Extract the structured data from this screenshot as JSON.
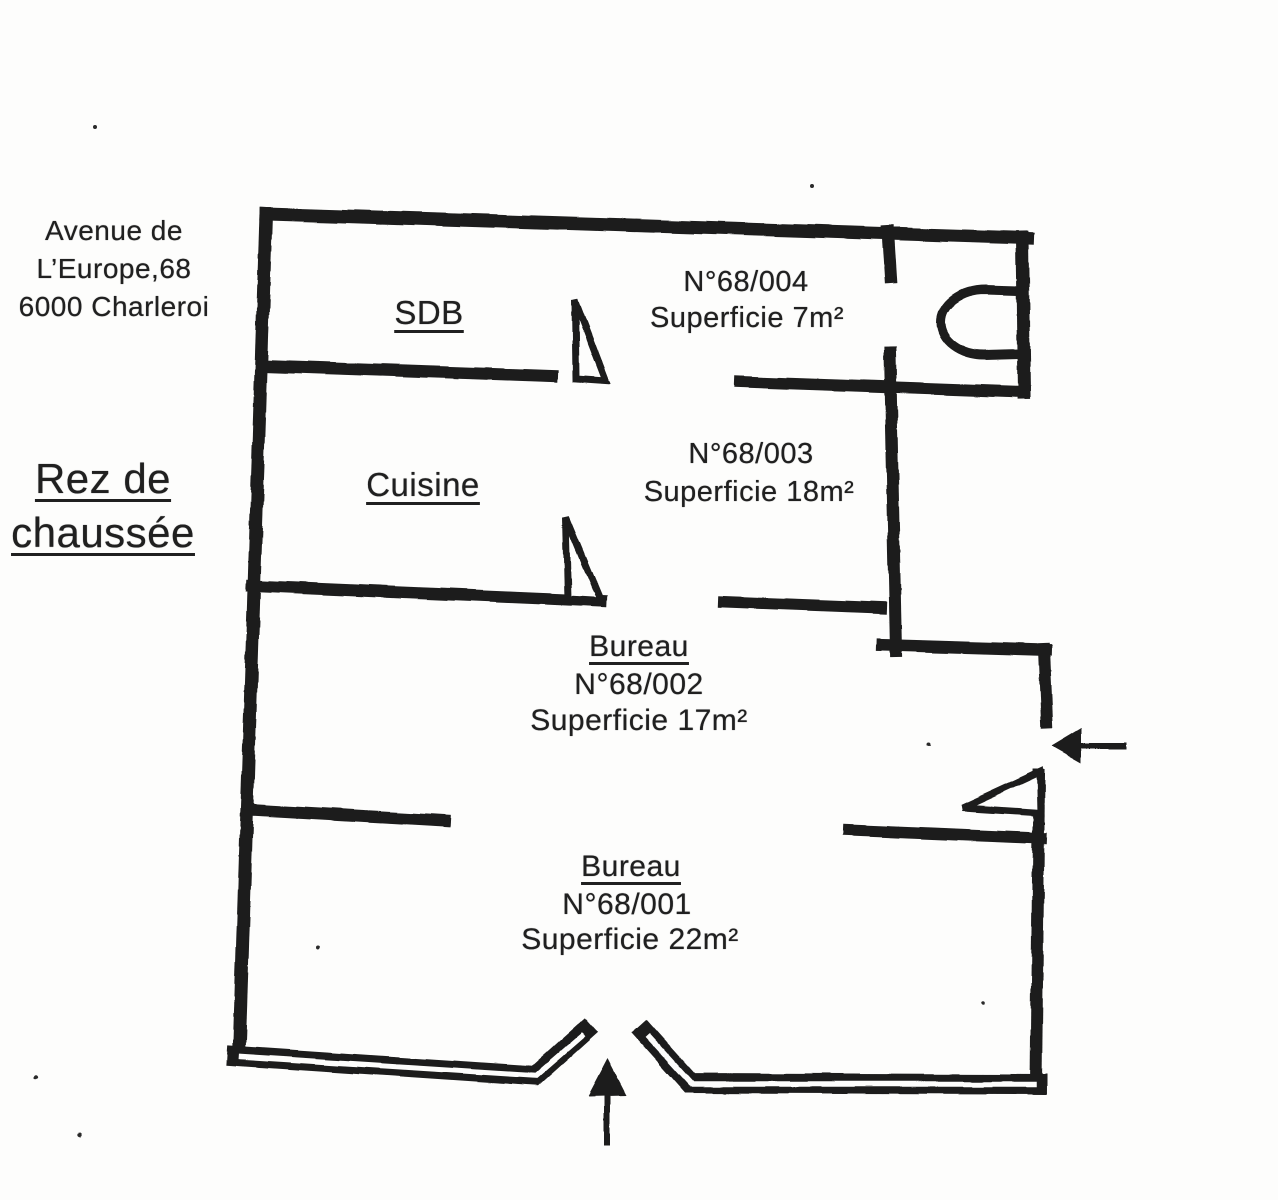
{
  "document": {
    "type_label": "floor-plan scan",
    "address": {
      "line1": "Avenue de",
      "line2": "L’Europe,68",
      "line3": "6000 Charleroi"
    },
    "floor": {
      "line1": "Rez de",
      "line2": "chaussée"
    },
    "colors": {
      "ink": "#1c1c1c",
      "paper": "#fdfdfc"
    }
  },
  "rooms": {
    "sdb": {
      "name": "SDB"
    },
    "r004": {
      "number": "N°68/004",
      "area": "Superficie 7m²"
    },
    "cuisine": {
      "name": "Cuisine"
    },
    "r003": {
      "number": "N°68/003",
      "area": "Superficie 18m²"
    },
    "r002": {
      "name": "Bureau",
      "number": "N°68/002",
      "area": "Superficie 17m²"
    },
    "r001": {
      "name": "Bureau",
      "number": "N°68/001",
      "area": "Superficie 22m²"
    }
  },
  "icons": {
    "door_swing": "right-triangle door leaf",
    "toilet": "half-oval wc bowl on wall",
    "entrance_arrow_right": "arrow pointing left into side entrance",
    "entrance_arrow_bottom": "arrow pointing up into main entrance"
  }
}
